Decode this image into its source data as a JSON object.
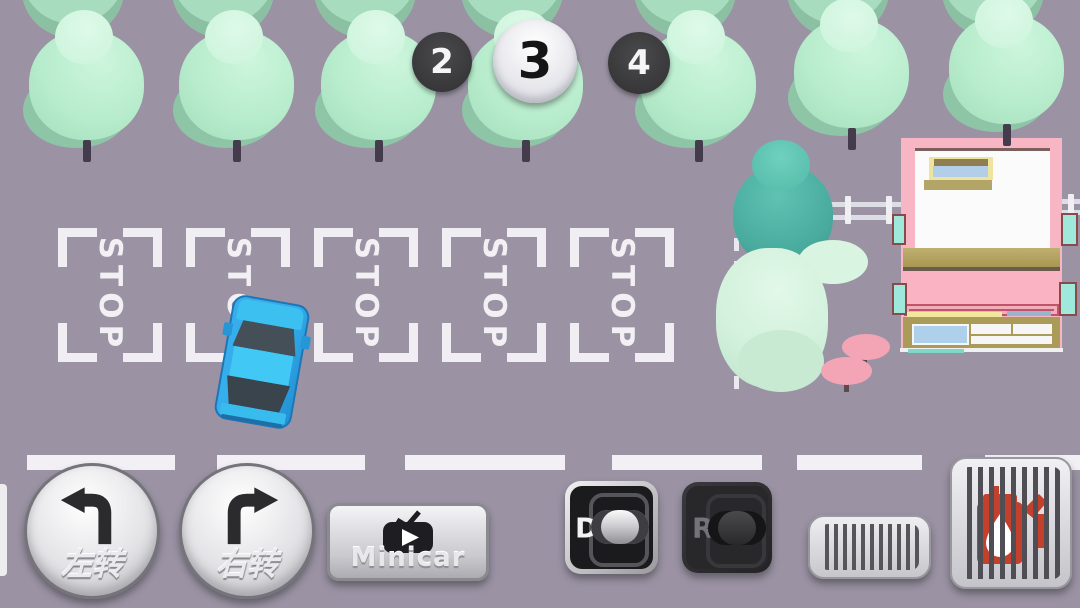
{
  "scene": {
    "stop_marking": "STOP",
    "parking_spot_count": 5
  },
  "levels": {
    "previous": "2",
    "current": "3",
    "next": "4"
  },
  "controls": {
    "left_turn_label": "左转",
    "right_turn_label": "右转",
    "minicar_label": "Minicar",
    "gear_drive_label": "D",
    "gear_reverse_label": "R"
  },
  "colors": {
    "ground": "#9B93A4",
    "tree_mint": "#B7ECCC",
    "tree_teal": "#4AAC9F",
    "building_pink": "#F8B5C4",
    "car_blue": "#36AEEC",
    "marking_white": "#F0EEF3",
    "fuel_icon_red": "#C2402C",
    "badge_dark": "#3A3A3C"
  }
}
